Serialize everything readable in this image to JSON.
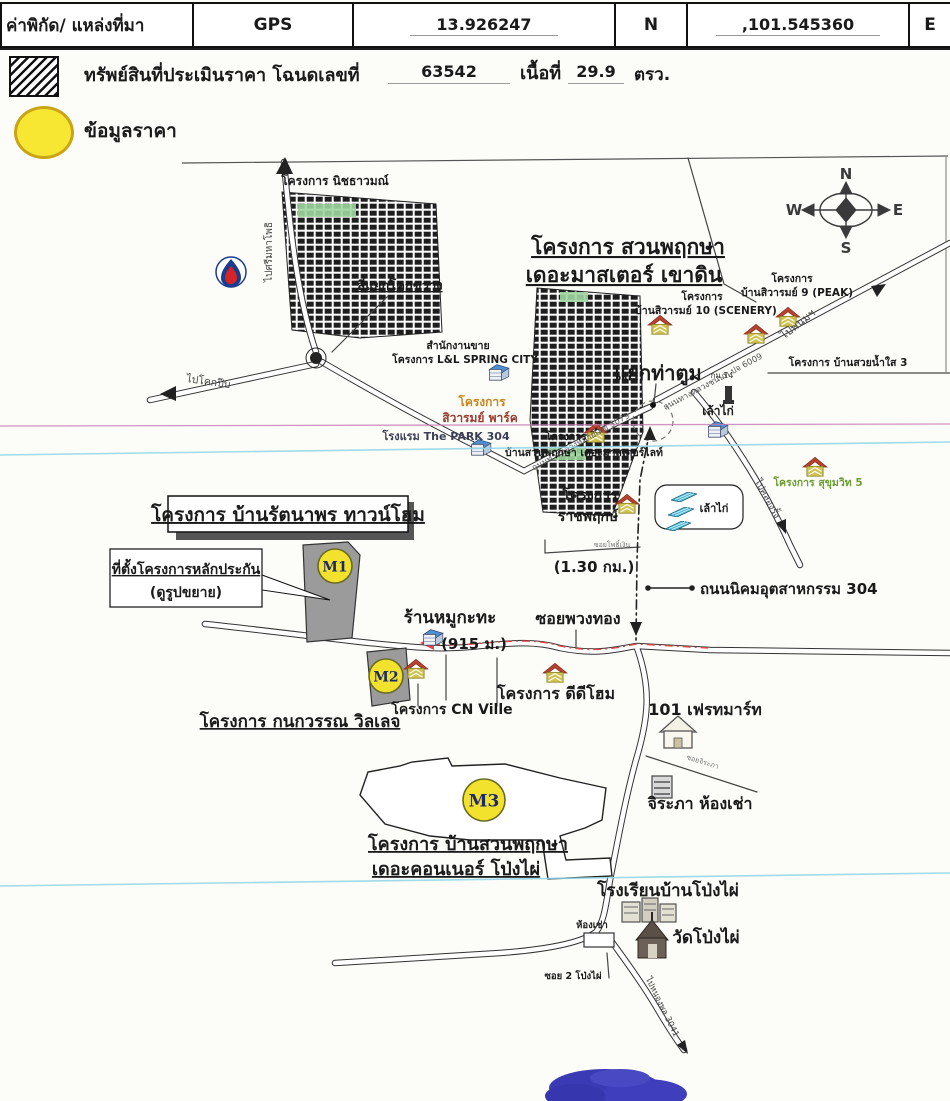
{
  "header": {
    "coord_label": "ค่าพิกัด/ แหล่งที่มา",
    "source": "GPS",
    "lat": "13.926247",
    "lat_dir": "N",
    "lng": ",101.545360",
    "lng_dir": "E",
    "deed_label": "ทรัพย์สินที่ประเมินราคา โฉนดเลขที่",
    "deed_no": "63542",
    "area_label": "เนื้อที่",
    "area_value": "29.9",
    "area_unit": "ตรว."
  },
  "legend": {
    "price_label": "ข้อมูลราคา"
  },
  "compass": {
    "n": "N",
    "e": "E",
    "s": "S",
    "w": "W"
  },
  "map": {
    "colors": {
      "marker_yellow": "#f2e22e",
      "marker_border": "#6b6b20",
      "marker_text": "#1c2a6b",
      "route_red": "#e04848",
      "scan_pink": "#c77bb5",
      "scan_cyan": "#8fd6e8",
      "stamp_blue": "#2a2ab0"
    },
    "markers": [
      {
        "id": "m1",
        "label": "M1",
        "x": 335,
        "y": 566,
        "r": 17
      },
      {
        "id": "m2",
        "label": "M2",
        "x": 386,
        "y": 676,
        "r": 17
      },
      {
        "id": "m3",
        "label": "M3",
        "x": 484,
        "y": 800,
        "r": 21
      }
    ],
    "house_icons": [
      {
        "x": 660,
        "y": 325
      },
      {
        "x": 788,
        "y": 317
      },
      {
        "x": 756,
        "y": 334
      },
      {
        "x": 596,
        "y": 433
      },
      {
        "x": 815,
        "y": 467
      },
      {
        "x": 627,
        "y": 504
      },
      {
        "x": 416,
        "y": 669
      },
      {
        "x": 555,
        "y": 673
      }
    ],
    "blue_buildings": [
      {
        "x": 498,
        "y": 373
      },
      {
        "x": 480,
        "y": 448
      },
      {
        "x": 717,
        "y": 430
      },
      {
        "x": 432,
        "y": 638
      }
    ],
    "coop_bars": [
      {
        "x": 684,
        "y": 497
      },
      {
        "x": 681,
        "y": 512
      },
      {
        "x": 678,
        "y": 526
      }
    ],
    "labels": [
      {
        "name": "proj-nitchawamon",
        "text": "โครงการ นิชธาวมณ์",
        "x": 335,
        "y": 185,
        "size": 12,
        "weight": 600
      },
      {
        "name": "to-srimahaphot",
        "text": "ไปศรีมหาโพธิ",
        "x": 272,
        "y": 252,
        "size": 10,
        "rotate": -90,
        "color": "#444"
      },
      {
        "name": "khok-khwang-intersection",
        "text": "สี่แยกโคกขวาง",
        "x": 400,
        "y": 290,
        "size": 13,
        "weight": "bold",
        "underline": true
      },
      {
        "name": "proj-suanpruksa-line1",
        "text": "โครงการ สวนพฤกษา",
        "x": 628,
        "y": 254,
        "size": 21,
        "weight": "bold",
        "underline": true
      },
      {
        "name": "proj-suanpruksa-line2",
        "text": "เดอะมาสเตอร์ เขาดิน",
        "x": 624,
        "y": 282,
        "size": 21,
        "weight": "bold",
        "underline": true
      },
      {
        "name": "proj-sivarom10-line1",
        "text": "โครงการ",
        "x": 702,
        "y": 300,
        "size": 10.5,
        "weight": 600
      },
      {
        "name": "proj-sivarom10-line2",
        "text": "บ้านสิวารมย์ 10 (SCENERY)",
        "x": 706,
        "y": 314,
        "size": 10.5,
        "weight": 600
      },
      {
        "name": "proj-sivarom9-line1",
        "text": "โครงการ",
        "x": 792,
        "y": 282,
        "size": 10.5,
        "weight": 600
      },
      {
        "name": "proj-sivarom9-line2",
        "text": "บ้านสิวารมย์ 9 (PEAK)",
        "x": 797,
        "y": 296,
        "size": 10.5,
        "weight": 600
      },
      {
        "name": "to-phanom",
        "text": "ไปพนมฯ",
        "x": 800,
        "y": 327,
        "size": 11,
        "rotate": -38,
        "color": "#444"
      },
      {
        "name": "road-6009-label",
        "text": "ถนนทางหลวงชนบท ปจ 6009",
        "x": 714,
        "y": 384,
        "size": 8.5,
        "rotate": -28,
        "color": "#555"
      },
      {
        "name": "km14-label",
        "text": "กม.14",
        "x": 722,
        "y": 378,
        "size": 8,
        "color": "#333"
      },
      {
        "name": "proj-baansuaynamsai",
        "text": "โครงการ บ้านสวยน้ำใส 3",
        "x": 848,
        "y": 366,
        "size": 10.5,
        "weight": 600
      },
      {
        "name": "tha-tum-junction",
        "text": "แยกท่าตูม",
        "x": 658,
        "y": 380,
        "size": 20,
        "weight": "bold"
      },
      {
        "name": "road-3079-label",
        "text": "ถนนทางหลวงหมายเลข 3079",
        "x": 582,
        "y": 444,
        "size": 8.5,
        "rotate": -29,
        "color": "#555"
      },
      {
        "name": "sales-office-line1",
        "text": "สำนักงานขาย",
        "x": 458,
        "y": 349,
        "size": 10.5,
        "weight": 600
      },
      {
        "name": "sales-office-line2",
        "text": "โครงการ L&L SPRING CITY",
        "x": 465,
        "y": 363,
        "size": 10.5,
        "weight": 600
      },
      {
        "name": "proj-sivarom-park-line1",
        "text": "โครงการ",
        "x": 482,
        "y": 406,
        "size": 12,
        "weight": "bold",
        "color": "#c8861e"
      },
      {
        "name": "proj-sivarom-park-line2",
        "text": "สิวารมย์ พาร์ค",
        "x": 480,
        "y": 422,
        "size": 12,
        "weight": "bold",
        "color": "#9a3b2e"
      },
      {
        "name": "hotel-park304",
        "text": "โรงแรม The PARK 304",
        "x": 446,
        "y": 440,
        "size": 11,
        "weight": 600,
        "color": "#3a3f55"
      },
      {
        "name": "proj-master-light-line1",
        "text": "โครงการ",
        "x": 566,
        "y": 440,
        "size": 10.5,
        "weight": 600
      },
      {
        "name": "proj-master-light-line2",
        "text": "บ้านสวนพฤกษา เดอะมาสเตอร์ไลท์",
        "x": 584,
        "y": 456,
        "size": 10.5,
        "weight": 600
      },
      {
        "name": "chicken-coop-1",
        "text": "เล้าไก่",
        "x": 718,
        "y": 415,
        "size": 12,
        "weight": 600
      },
      {
        "name": "proj-sukhumvit5",
        "text": "โครงการ สุขุมวิท 5",
        "x": 818,
        "y": 486,
        "size": 10.5,
        "weight": 600,
        "color": "#6d9d35"
      },
      {
        "name": "to-khlong-rang",
        "text": "ไปคลองรั้ง",
        "x": 765,
        "y": 500,
        "size": 9.5,
        "rotate": 62,
        "color": "#444"
      },
      {
        "name": "proj-ratchapruek-line1",
        "text": "โครงการ",
        "x": 590,
        "y": 500,
        "size": 14,
        "weight": "bold"
      },
      {
        "name": "proj-ratchapruek-line2",
        "text": "ราชพฤกษ์",
        "x": 588,
        "y": 521,
        "size": 14,
        "weight": "bold"
      },
      {
        "name": "chicken-coop-2",
        "text": "เล้าไก่",
        "x": 714,
        "y": 512,
        "size": 11,
        "weight": 600
      },
      {
        "name": "distance-130km",
        "text": "(1.30 กม.)",
        "x": 594,
        "y": 572,
        "size": 15,
        "weight": 600
      },
      {
        "name": "soi-pho-ngern",
        "text": "ซอยโพธิ์เงิน",
        "x": 612,
        "y": 547,
        "size": 7,
        "color": "#777"
      },
      {
        "name": "road-nikhom-304",
        "text": "ถนนนิคมอุตสาหกรรม 304",
        "x": 700,
        "y": 594,
        "size": 15,
        "weight": "bold",
        "anchor": "start"
      },
      {
        "name": "proj-rattanaporn",
        "text": "โครงการ บ้านรัตนาพร ทาวน์โฮม",
        "x": 288,
        "y": 521,
        "size": 19,
        "weight": "bold",
        "underline": true
      },
      {
        "name": "collateral-callout-line1",
        "text": "ที่ตั้งโครงการหลักประกัน",
        "x": 186,
        "y": 574,
        "size": 14,
        "weight": "bold",
        "underline": true
      },
      {
        "name": "collateral-callout-line2",
        "text": "(ดูรูปขยาย)",
        "x": 186,
        "y": 597,
        "size": 14,
        "weight": "bold"
      },
      {
        "name": "mookata-shop",
        "text": "ร้านหมูกะทะ",
        "x": 450,
        "y": 623,
        "size": 17,
        "weight": "bold"
      },
      {
        "name": "distance-915m",
        "text": "(915 ม.)",
        "x": 474,
        "y": 649,
        "size": 15,
        "weight": 600
      },
      {
        "name": "soi-puang-thong",
        "text": "ซอยพวงทอง",
        "x": 578,
        "y": 624,
        "size": 16,
        "weight": "bold"
      },
      {
        "name": "proj-ddhome",
        "text": "โครงการ ดีดีโฮม",
        "x": 556,
        "y": 699,
        "size": 16,
        "weight": "bold"
      },
      {
        "name": "proj-cn-ville",
        "text": "โครงการ CN Ville",
        "x": 452,
        "y": 714,
        "size": 14,
        "weight": "bold"
      },
      {
        "name": "proj-kanokwan",
        "text": "โครงการ กนกวรรณ วิลเลจ",
        "x": 300,
        "y": 727,
        "size": 17,
        "weight": "bold",
        "underline": true
      },
      {
        "name": "freshmart-101",
        "text": "101 เฟรทมาร์ท",
        "x": 705,
        "y": 715,
        "size": 16,
        "weight": "bold"
      },
      {
        "name": "soi-jirapha",
        "text": "ซอยจิระภา",
        "x": 702,
        "y": 764,
        "size": 7,
        "rotate": 17,
        "color": "#777"
      },
      {
        "name": "jirapha-rental",
        "text": "จิระภา ห้องเช่า",
        "x": 700,
        "y": 809,
        "size": 16,
        "weight": "bold"
      },
      {
        "name": "proj-connor-line1",
        "text": "โครงการ บ้านสวนพฤกษา",
        "x": 468,
        "y": 850,
        "size": 18,
        "weight": "bold",
        "underline": true
      },
      {
        "name": "proj-connor-line2",
        "text": "เดอะคอนเนอร์ โป่งไผ่",
        "x": 456,
        "y": 875,
        "size": 18,
        "weight": "bold",
        "underline": true
      },
      {
        "name": "school-pongphai",
        "text": "โรงเรียนบ้านโป่งไผ่",
        "x": 668,
        "y": 896,
        "size": 17,
        "weight": "bold"
      },
      {
        "name": "wat-pongphai",
        "text": "วัดโป่งไผ่",
        "x": 706,
        "y": 943,
        "size": 17,
        "weight": "bold"
      },
      {
        "name": "rental-rooms",
        "text": "ห้องเช่า",
        "x": 592,
        "y": 928,
        "size": 9.5,
        "weight": 600
      },
      {
        "name": "soi-2-pongphai",
        "text": "ซอย 2 โป่งไผ่",
        "x": 573,
        "y": 979,
        "size": 9.5,
        "weight": 600
      },
      {
        "name": "to-nongphon-3041",
        "text": "ไปหนองพล 3041",
        "x": 660,
        "y": 1008,
        "size": 8.5,
        "rotate": 64,
        "color": "#444"
      },
      {
        "name": "to-khok-pip",
        "text": "ไปโคกปีบ",
        "x": 208,
        "y": 385,
        "size": 10.5,
        "rotate": 8,
        "color": "#444"
      }
    ]
  }
}
